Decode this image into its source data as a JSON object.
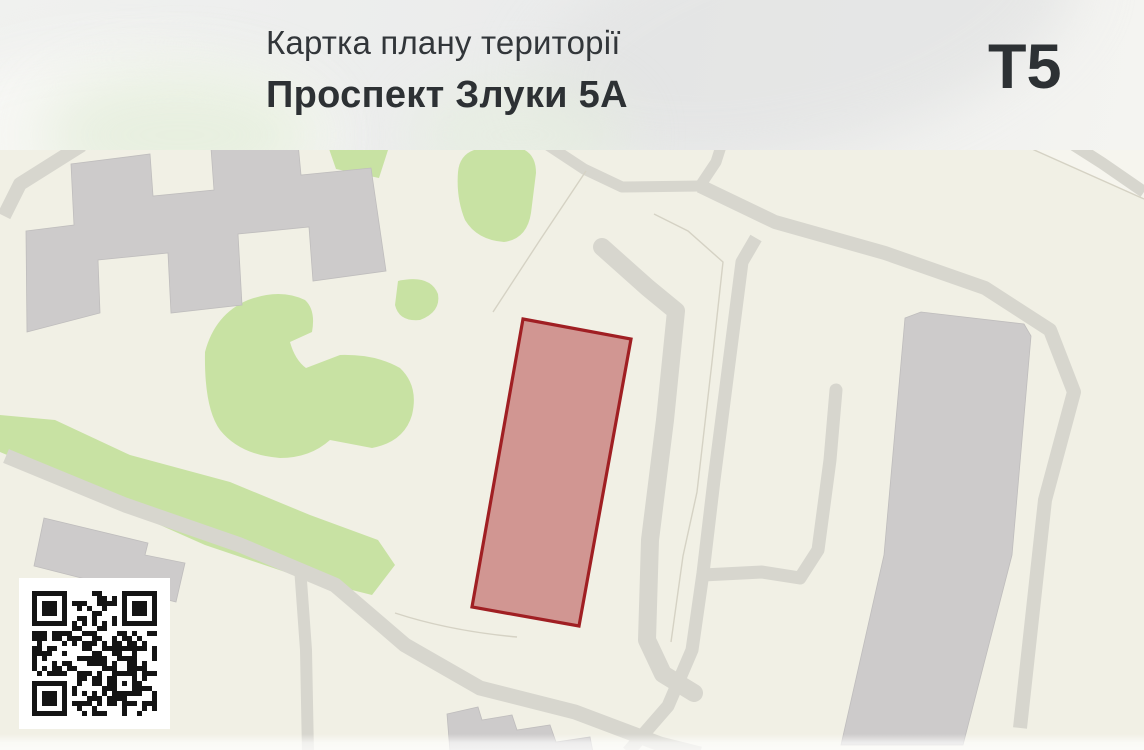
{
  "header": {
    "title": "Картка плану території",
    "subtitle": "Проспект Злуки 5А",
    "territory_code": "T5"
  },
  "map": {
    "kind": "territory-plan-map",
    "parcel": {
      "name": "highlighted-parcel",
      "points": "523,319 631,339 579,626 472,607",
      "stroke": "#a01f23",
      "fill": "rgba(178,60,64,0.5)",
      "stroke_width": "3.2"
    },
    "colors": {
      "background": "#f1f0e5",
      "greenery": "#c8e2a3",
      "roads": "#d7d6ce",
      "buildings": "#cdcbcb",
      "parcel_stroke": "#a01f23",
      "parcel_fill": "rgba(178,60,64,0.5)"
    },
    "qr_label": "qr-code"
  }
}
